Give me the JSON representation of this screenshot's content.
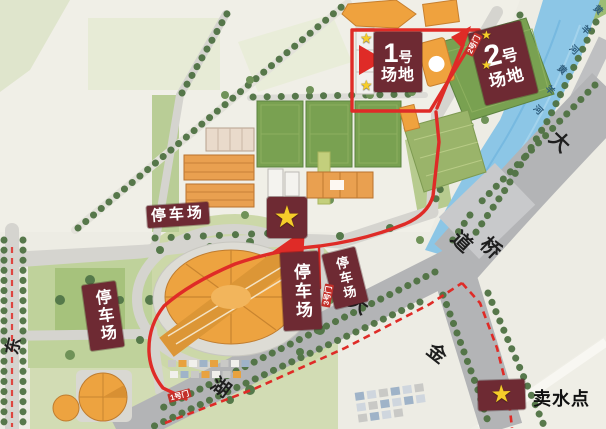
{
  "venue_labels": {
    "field1": {
      "number": "1",
      "suffix": "号",
      "line2": "场地"
    },
    "field2": {
      "number": "2",
      "suffix": "号",
      "line2": "场地"
    },
    "parking": "停车场"
  },
  "gates": {
    "gate1": "1号门",
    "gate2": "2号门",
    "gate3": "3号门"
  },
  "road_labels": {
    "east": "东",
    "da_north": "大",
    "dao": "道",
    "qiao": "桥",
    "jin": "金",
    "da_south": "大",
    "hu": "湖"
  },
  "river_chars": [
    "黄",
    "羊",
    "河",
    "黄",
    "羊",
    "河"
  ],
  "legend": {
    "water_point_label": "卖水点"
  },
  "icons": {
    "star": "★"
  },
  "colors": {
    "route_red": "#df2b27",
    "label_maroon": "#6e2a33",
    "gate_red": "#c2302a",
    "star_yellow": "#f6cd2a",
    "river_blue": "#8cc6e6",
    "field_green": "#79a151",
    "building_orange": "#eda340"
  }
}
